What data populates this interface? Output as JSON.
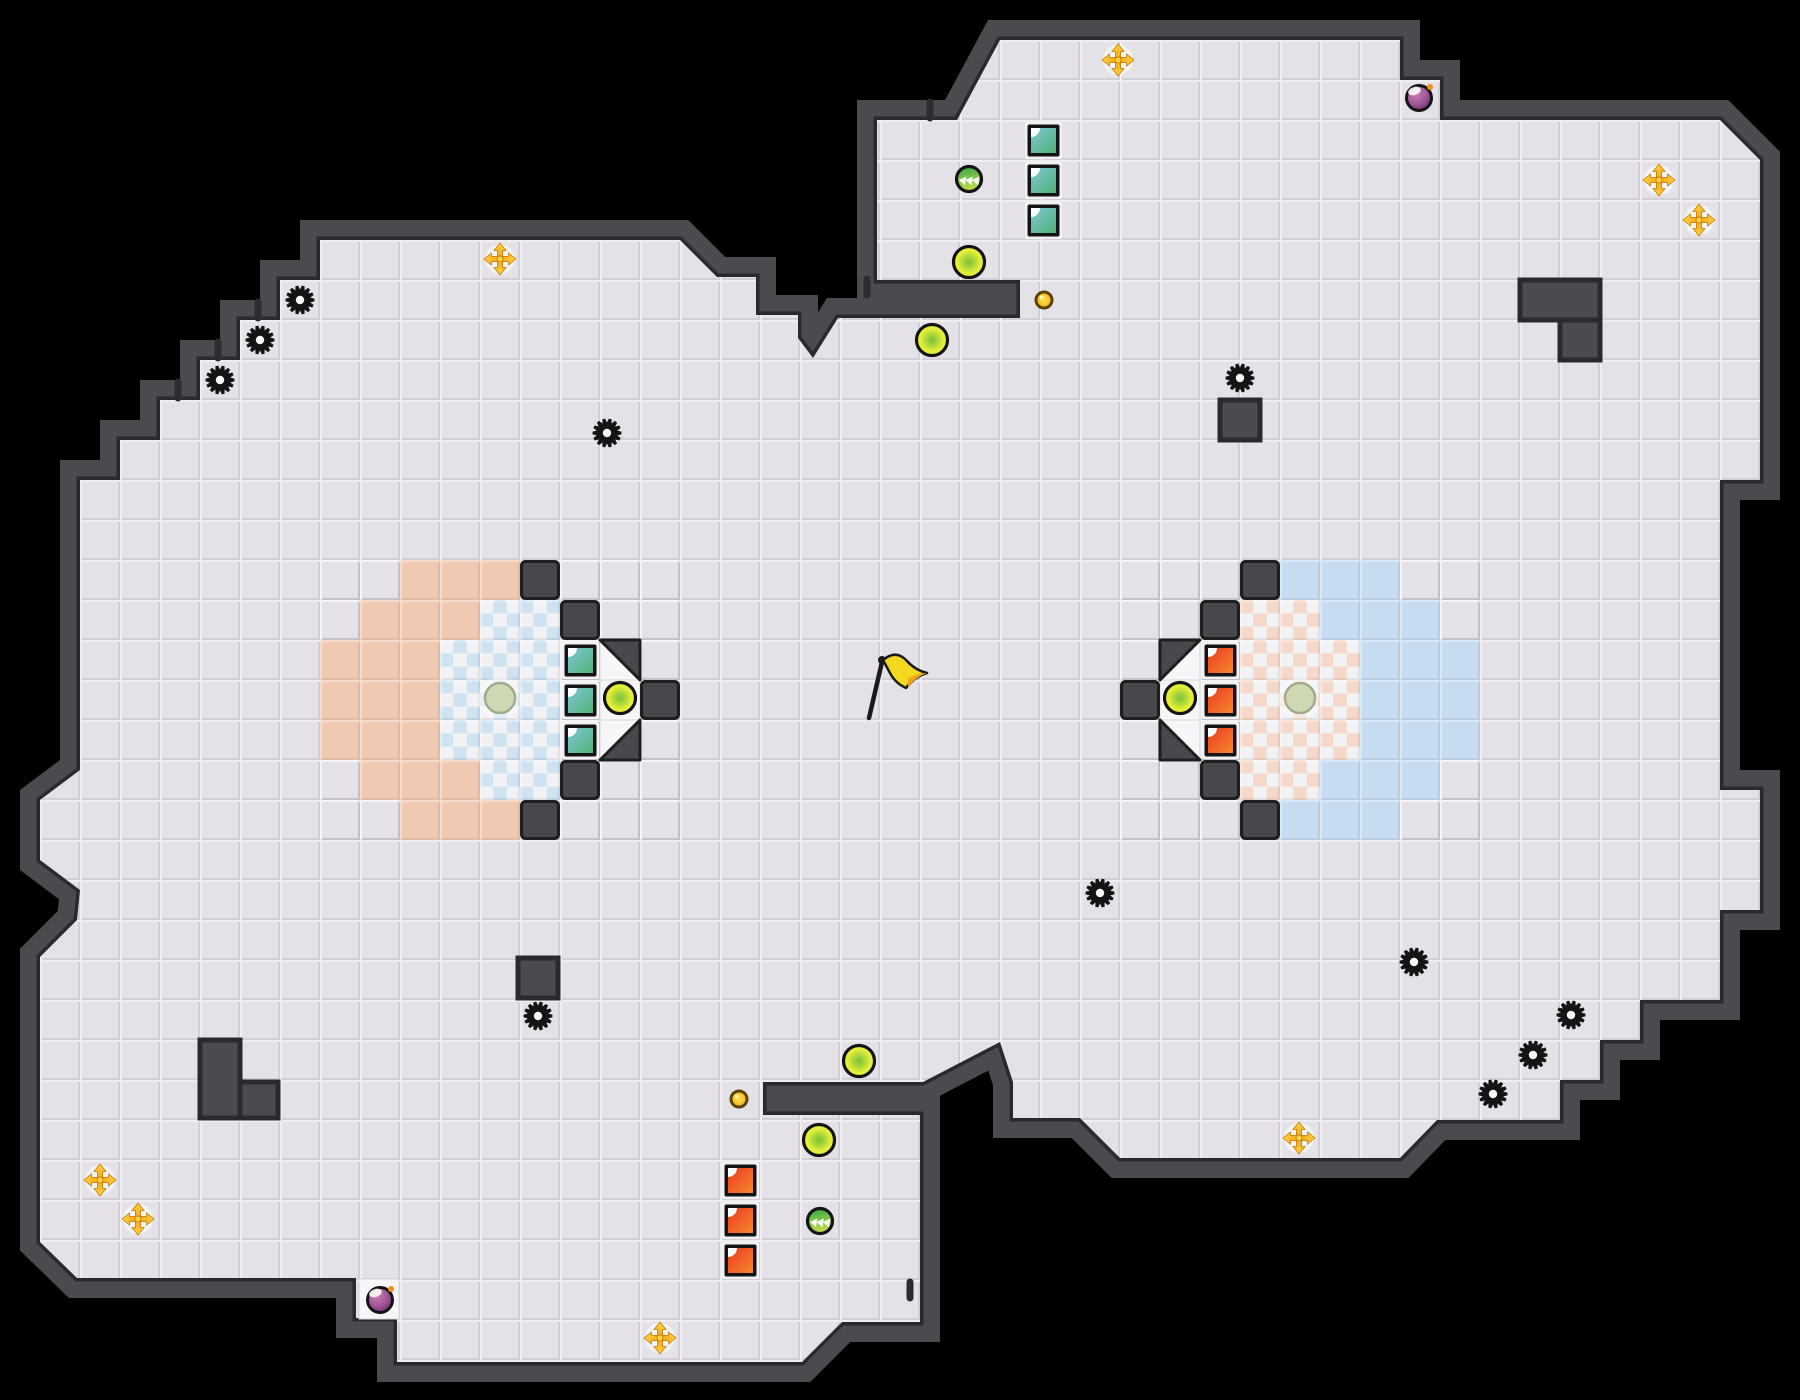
{
  "app": {
    "name": "tile-arena-map",
    "description": "Top-down CTF arena map: two team bases with checkered pads, saw hazards, gold movement pickups, orbs, bombs, coins, switch-door blocks and a central neutral flag.",
    "canvas": {
      "width": 1800,
      "height": 1400,
      "tile": 40
    }
  },
  "colors": {
    "outside": "#000000",
    "wall": "#4b4b4f",
    "wall_edge": "#2a2a2e",
    "floor": "#e4e2e6",
    "floor_hi": "#f0eef3",
    "floor_sh": "#d2d0d6",
    "dark_tile": "#48484c",
    "dark_tile_edge": "#1e1e20",
    "white_tile": "#f6f6f8",
    "ring_pink": "#f0c9b2",
    "ring_blue": "#c7dcf0",
    "check_blue": "#cfe2f2",
    "check_pink": "#f5d8ca",
    "check_base": "#f2f2f5",
    "teal_a": "#7ec6da",
    "teal_b": "#50b274",
    "red_a": "#ee3820",
    "red_b": "#f4872f",
    "block_frame": "#141416",
    "block_rim": "#f2f2f4",
    "gold_a": "#fdd141",
    "gold_b": "#f09c14",
    "orb_green_center": "#7cc03c",
    "orb_yellow": "#e6ee38",
    "arrow_orb_a": "#2ea648",
    "arrow_orb_b": "#c2dc48",
    "bomb_a": "#cd7fb0",
    "bomb_b": "#6e3070",
    "bomb_spark": "#f09018",
    "coin_a": "#ffe14a",
    "coin_b": "#f3b61b",
    "coin_edge": "#5a4408",
    "pad_fill": "#cfd9b4",
    "pad_edge": "#a2ab90",
    "flag_yellow": "#f2d91f",
    "flag_orange": "#f2a71b",
    "ink": "#1a1a1c",
    "tick": "#2c2c30"
  },
  "map": {
    "outline": [
      [
        400,
        240
      ],
      [
        680,
        240
      ],
      [
        717,
        277
      ],
      [
        756,
        277
      ],
      [
        756,
        315
      ],
      [
        798,
        315
      ],
      [
        798,
        338
      ],
      [
        813,
        358
      ],
      [
        838,
        318
      ],
      [
        1020,
        318
      ],
      [
        1020,
        280
      ],
      [
        877,
        280
      ],
      [
        877,
        120
      ],
      [
        957,
        120
      ],
      [
        1000,
        40
      ],
      [
        1400,
        40
      ],
      [
        1400,
        80
      ],
      [
        1440,
        80
      ],
      [
        1440,
        120
      ],
      [
        1720,
        120
      ],
      [
        1760,
        160
      ],
      [
        1760,
        480
      ],
      [
        1720,
        480
      ],
      [
        1720,
        790
      ],
      [
        1760,
        790
      ],
      [
        1760,
        910
      ],
      [
        1720,
        910
      ],
      [
        1720,
        1000
      ],
      [
        1640,
        1000
      ],
      [
        1640,
        1040
      ],
      [
        1600,
        1040
      ],
      [
        1600,
        1080
      ],
      [
        1560,
        1080
      ],
      [
        1560,
        1120
      ],
      [
        1437,
        1120
      ],
      [
        1400,
        1158
      ],
      [
        1120,
        1158
      ],
      [
        1080,
        1118
      ],
      [
        1013,
        1118
      ],
      [
        1013,
        1082
      ],
      [
        1000,
        1042
      ],
      [
        923,
        1082
      ],
      [
        763,
        1082
      ],
      [
        763,
        1115
      ],
      [
        920,
        1115
      ],
      [
        920,
        1322
      ],
      [
        842,
        1322
      ],
      [
        802,
        1362
      ],
      [
        397,
        1362
      ],
      [
        397,
        1318
      ],
      [
        356,
        1318
      ],
      [
        356,
        1278
      ],
      [
        77,
        1278
      ],
      [
        40,
        1242
      ],
      [
        40,
        957
      ],
      [
        77,
        920
      ],
      [
        80,
        890
      ],
      [
        40,
        860
      ],
      [
        40,
        800
      ],
      [
        80,
        770
      ],
      [
        80,
        480
      ],
      [
        120,
        480
      ],
      [
        120,
        440
      ],
      [
        160,
        440
      ],
      [
        160,
        400
      ],
      [
        200,
        400
      ],
      [
        200,
        360
      ],
      [
        240,
        360
      ],
      [
        240,
        320
      ],
      [
        280,
        320
      ],
      [
        280,
        280
      ],
      [
        320,
        280
      ],
      [
        320,
        240
      ]
    ],
    "obstacles": [
      [
        1520,
        280,
        80,
        40
      ],
      [
        1560,
        320,
        40,
        40
      ],
      [
        1220,
        400,
        40,
        40
      ],
      [
        518,
        958,
        40,
        40
      ],
      [
        200,
        1040,
        40,
        78
      ],
      [
        240,
        1082,
        38,
        36
      ]
    ],
    "dark_tiles": [
      [
        13,
        14
      ],
      [
        14,
        15
      ],
      [
        16,
        17
      ],
      [
        14,
        19
      ],
      [
        13,
        20
      ],
      [
        31,
        14
      ],
      [
        30,
        15
      ],
      [
        28,
        17
      ],
      [
        30,
        19
      ],
      [
        31,
        20
      ]
    ],
    "white_tiles": [
      [
        15,
        16
      ],
      [
        15,
        17
      ],
      [
        15,
        18
      ],
      [
        29,
        16
      ],
      [
        29,
        17
      ],
      [
        29,
        18
      ]
    ],
    "white_rects": [
      [
        359,
        1279,
        40,
        40
      ]
    ],
    "triangles": [
      [
        [
          600,
          640
        ],
        [
          640,
          640
        ],
        [
          640,
          680
        ]
      ],
      [
        [
          640,
          720
        ],
        [
          640,
          760
        ],
        [
          600,
          760
        ]
      ],
      [
        [
          1160,
          640
        ],
        [
          1200,
          640
        ],
        [
          1160,
          680
        ]
      ],
      [
        [
          1160,
          720
        ],
        [
          1200,
          760
        ],
        [
          1160,
          760
        ]
      ]
    ],
    "ring_pink": [
      [
        14,
        [
          10,
          11,
          12
        ]
      ],
      [
        15,
        [
          9,
          10,
          11
        ]
      ],
      [
        16,
        [
          8,
          9,
          10
        ]
      ],
      [
        17,
        [
          8,
          9,
          10
        ]
      ],
      [
        18,
        [
          8,
          9,
          10
        ]
      ],
      [
        19,
        [
          9,
          10,
          11
        ]
      ],
      [
        20,
        [
          10,
          11,
          12
        ]
      ]
    ],
    "ring_blue": [
      [
        14,
        [
          32,
          33,
          34
        ]
      ],
      [
        15,
        [
          33,
          34,
          35
        ]
      ],
      [
        16,
        [
          34,
          35,
          36
        ]
      ],
      [
        17,
        [
          34,
          35,
          36
        ]
      ],
      [
        18,
        [
          34,
          35,
          36
        ]
      ],
      [
        19,
        [
          33,
          34,
          35
        ]
      ],
      [
        20,
        [
          32,
          33,
          34
        ]
      ]
    ],
    "checker_blue": [
      [
        15,
        [
          12,
          13
        ]
      ],
      [
        16,
        [
          11,
          12,
          13
        ]
      ],
      [
        17,
        [
          11,
          12,
          13
        ]
      ],
      [
        18,
        [
          11,
          12,
          13
        ]
      ],
      [
        19,
        [
          12,
          13
        ]
      ]
    ],
    "checker_pink": [
      [
        15,
        [
          31,
          32
        ]
      ],
      [
        16,
        [
          31,
          32,
          33
        ]
      ],
      [
        17,
        [
          31,
          32,
          33
        ]
      ],
      [
        18,
        [
          31,
          32,
          33
        ]
      ],
      [
        19,
        [
          31,
          32
        ]
      ]
    ],
    "door_ticks": [
      [
        258,
        310
      ],
      [
        218,
        350
      ],
      [
        178,
        390
      ],
      [
        930,
        110
      ],
      [
        867,
        287
      ],
      [
        910,
        1290
      ]
    ]
  },
  "items": {
    "base_pads": [
      [
        500,
        698
      ],
      [
        1300,
        698
      ]
    ],
    "gears": [
      [
        300,
        300
      ],
      [
        260,
        340
      ],
      [
        220,
        380
      ],
      [
        607,
        433
      ],
      [
        1240,
        378
      ],
      [
        1100,
        893
      ],
      [
        538,
        1016
      ],
      [
        1414,
        962
      ],
      [
        1571,
        1015
      ],
      [
        1533,
        1055
      ],
      [
        1493,
        1094
      ]
    ],
    "gold_crosses": [
      [
        500,
        259
      ],
      [
        1118,
        60
      ],
      [
        1659,
        180
      ],
      [
        1699,
        220
      ],
      [
        1299,
        1138
      ],
      [
        100,
        1180
      ],
      [
        138,
        1219
      ],
      [
        660,
        1338
      ]
    ],
    "coins": [
      [
        1044,
        300
      ],
      [
        739,
        1099
      ]
    ],
    "yellow_orbs": [
      [
        620,
        698
      ],
      [
        1180,
        698
      ],
      [
        969,
        262
      ],
      [
        932,
        340
      ],
      [
        859,
        1061
      ],
      [
        819,
        1140
      ]
    ],
    "arrow_orbs": [
      [
        969,
        179
      ],
      [
        820,
        1221
      ]
    ],
    "bombs": [
      [
        1419,
        98
      ],
      [
        380,
        1300
      ]
    ],
    "flag": [
      878,
      664
    ]
  },
  "blocks": {
    "teal": [
      [
        562,
        642
      ],
      [
        562,
        682
      ],
      [
        562,
        722
      ],
      [
        1025,
        122
      ],
      [
        1025,
        162
      ],
      [
        1025,
        202
      ]
    ],
    "red": [
      [
        1202,
        642
      ],
      [
        1202,
        682
      ],
      [
        1202,
        722
      ],
      [
        722,
        1162
      ],
      [
        722,
        1202
      ],
      [
        722,
        1242
      ]
    ]
  },
  "legend": {
    "gear": "black saw hazard",
    "gold_cross": "gold four-way launcher pickup",
    "yellow_orb": "energy orb",
    "arrow_orb": "speed orb with white arrows",
    "bomb": "purple bomb pickup",
    "coin": "small gold coin",
    "teal_block": "teal switch-door block",
    "red_block": "red switch-door block",
    "base_pad": "pale spawn pad at base center",
    "flag": "neutral yellow flag",
    "door_tick": "door marker on wall"
  }
}
